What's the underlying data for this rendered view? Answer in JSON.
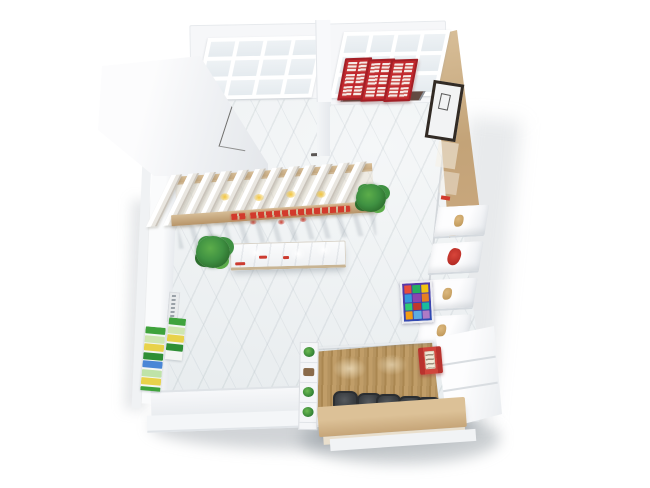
{
  "scene": {
    "type": "3d-interior-render",
    "view": "top-down isometric floor plan",
    "subject": "small retail cafe interior",
    "background": "#ffffff",
    "legible_text": "none"
  },
  "palette": {
    "bg": "#ffffff",
    "wall_white": "#f6f7f9",
    "wall_shade": "#e4e7eb",
    "glass": "#eef2f5",
    "mullion": "#ffffff",
    "floor_base": "#edf0f2",
    "threshold": "#35302c",
    "wood_light": "#d9c09a",
    "wood_mid": "#c3a378",
    "wood_dark": "#a8865a",
    "accent_red": "#c1282e",
    "dark_red": "#a31f26",
    "sign_red": "#d23a2c",
    "accent_yellow": "#f2c53d",
    "plant_dark": "#2c6e2d",
    "plant_mid": "#3f9142",
    "plant_light": "#5cad4a",
    "chair": "#3a3e42",
    "chair_rim": "#2b2e31",
    "frame_dark": "#322b25",
    "kiosk_bg1": "#5a35a8",
    "kiosk_bg2": "#2c4db3"
  },
  "structure": {
    "back_windows": {
      "left": {
        "cols": 4,
        "rows": 3
      },
      "right": {
        "cols": 4,
        "rows": 3
      }
    },
    "entry_panels": {
      "count": 3,
      "slat_cols": 2,
      "slat_rows": 3
    },
    "canopy": {
      "fin_count": 12
    },
    "seating": {
      "chair_count": 5
    },
    "right_shelves": {
      "items": [
        "tan-item",
        "red-item",
        "tan-item",
        "tan-item"
      ]
    },
    "divider_shelf": {
      "cells": [
        "plant",
        "box",
        "plant",
        "plant"
      ]
    },
    "plants": {
      "count": 2
    }
  },
  "kiosk_poster": {
    "tiles": [
      "#e74c3c",
      "#27ae60",
      "#f1c40f",
      "#3498db",
      "#8e44ad",
      "#e67e22",
      "#2ecc71",
      "#c0392b",
      "#1abc9c",
      "#f39c12",
      "#5dade2",
      "#af7ac5"
    ]
  },
  "left_wall": {
    "poster_blocks": [
      "#3fa33c",
      "#cfe6b0",
      "#e8d24a",
      "#2f8f35",
      "#4a86d6",
      "#bfe3a8",
      "#e8d24a",
      "#3fa33c"
    ]
  }
}
